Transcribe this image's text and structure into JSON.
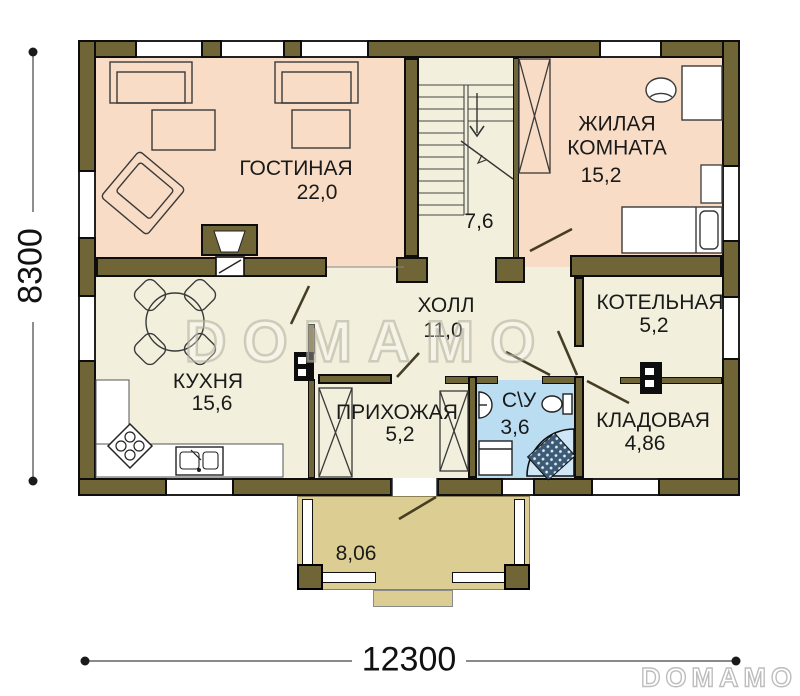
{
  "plan": {
    "watermark": "DOMAMO",
    "logo": "DOMAMO",
    "dimensions": {
      "width": "12300",
      "height": "8300"
    },
    "rooms": {
      "living": {
        "name": "ГОСТИНАЯ",
        "area": "22,0"
      },
      "stairs": {
        "area": "7,6"
      },
      "bedroom": {
        "name": "ЖИЛАЯ КОМНАТА",
        "area": "15,2"
      },
      "hall": {
        "name": "ХОЛЛ",
        "area": "11,0"
      },
      "boiler": {
        "name": "КОТЕЛЬНАЯ",
        "area": "5,2"
      },
      "kitchen": {
        "name": "КУХНЯ",
        "area": "15,6"
      },
      "entry": {
        "name": "ПРИХОЖАЯ",
        "area": "5,2"
      },
      "wc": {
        "name": "С\\У",
        "area": "3,6"
      },
      "storage": {
        "name": "КЛАДОВАЯ",
        "area": "4,86"
      },
      "porch": {
        "area": "8,06"
      }
    },
    "colors": {
      "wall": "#6F6537",
      "floor_warm": "#F8DCC5",
      "floor_light": "#F2F0DC",
      "floor_wet": "#BADDF2",
      "porch": "#DCCE92",
      "outline": "#0d0d0d"
    }
  }
}
